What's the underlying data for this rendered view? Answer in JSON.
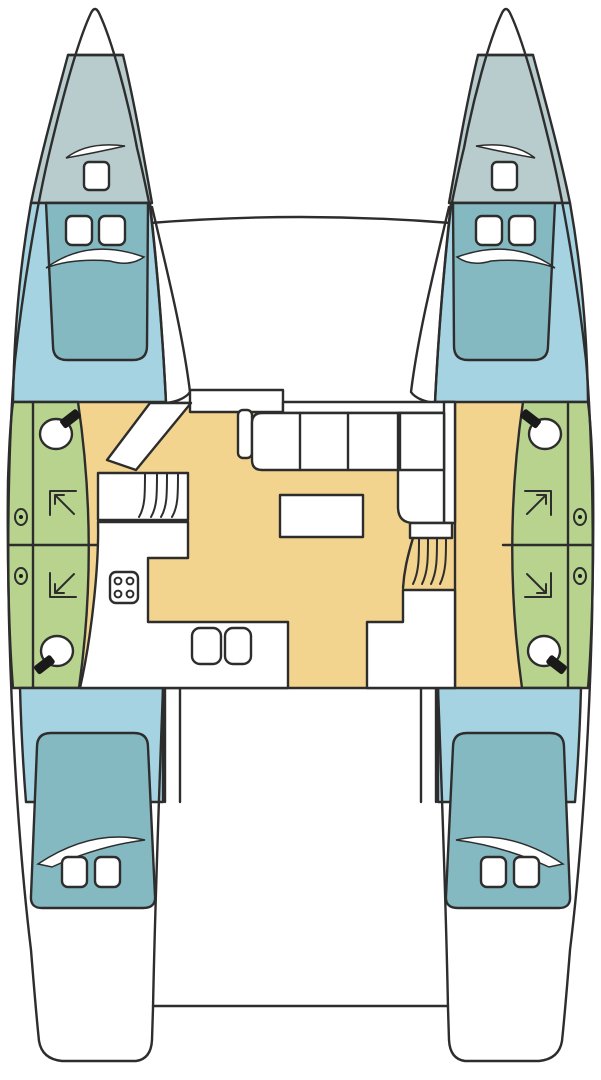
{
  "diagram": {
    "type": "boat-deck-plan",
    "subject": "catamaran-interior-layout-top-view",
    "orientation": "bow-up",
    "port_hull": {
      "forepeak": {
        "items": [
          "deck-hatch",
          "vent-swoosh"
        ]
      },
      "forward_cabin": {
        "berth": "double",
        "pillows": 2,
        "items": [
          "blanket-swoosh"
        ]
      },
      "bathrooms": [
        {
          "position": "forward",
          "items": [
            "toilet",
            "shower",
            "porthole"
          ]
        },
        {
          "position": "aft",
          "items": [
            "toilet",
            "shower",
            "porthole"
          ]
        }
      ],
      "aft_cabin": {
        "berth": "double",
        "pillows": 2,
        "items": [
          "blanket-swoosh"
        ]
      },
      "stairs_steps": 4,
      "companionway_doors": 1
    },
    "starboard_hull": {
      "forepeak": {
        "items": [
          "deck-hatch",
          "vent-swoosh"
        ]
      },
      "forward_cabin": {
        "berth": "double",
        "pillows": 2,
        "items": [
          "blanket-swoosh"
        ]
      },
      "bathrooms": [
        {
          "position": "forward",
          "items": [
            "toilet",
            "shower",
            "porthole"
          ]
        },
        {
          "position": "aft",
          "items": [
            "toilet",
            "shower",
            "porthole"
          ]
        }
      ],
      "aft_cabin": {
        "berth": "double",
        "pillows": 2,
        "items": [
          "blanket-swoosh"
        ]
      },
      "stairs_steps": 4,
      "companionway_doors": 1
    },
    "salon": {
      "settee_seats": 4,
      "settee_corner_seats": 2,
      "table": 1,
      "galley": {
        "stove_burners": 4,
        "sink_basins": 2
      }
    },
    "foredeck": {
      "items": [
        "cross-beam",
        "trampoline-area",
        "mast-step"
      ]
    },
    "cockpit": {
      "items": [
        "aft-deck",
        "transom-platform"
      ]
    }
  },
  "colors": {
    "outline": "#2d2d2d",
    "hull_white": "#ffffff",
    "forepeak_gray": "#b8cccd",
    "cabin_floor_blue": "#a6d3e2",
    "berth_teal": "#85b9c2",
    "bathroom_green": "#b7d38d",
    "salon_floor_tan": "#f3d48e",
    "symbol_black": "#1a1a1a"
  }
}
